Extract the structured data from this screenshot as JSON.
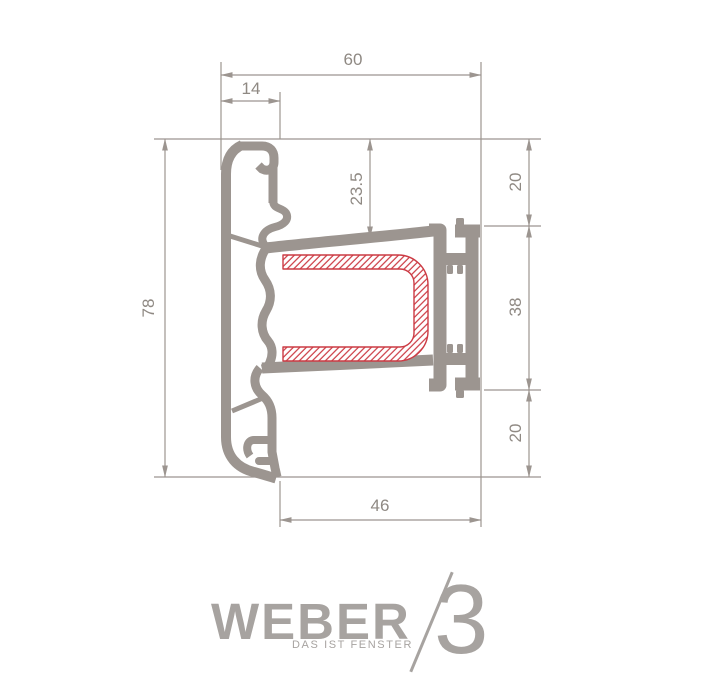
{
  "drawing": {
    "type": "technical-cross-section",
    "subject": "window-profile",
    "dimensions": {
      "top_width": "60",
      "cover_width": "14",
      "sash_top_depth": "23.5",
      "overall_height": "78",
      "right_top": "20",
      "right_middle": "38",
      "right_bottom": "20",
      "bottom_width": "46"
    },
    "colors": {
      "profile_gray": "#9c9590",
      "dimension_gray": "#9c9590",
      "label_gray": "#8f8983",
      "hatch_red": "#cc3b44",
      "background": "#ffffff"
    }
  },
  "logo": {
    "brand": "WEBER",
    "tagline": "DAS IST FENSTER",
    "series": "3"
  }
}
